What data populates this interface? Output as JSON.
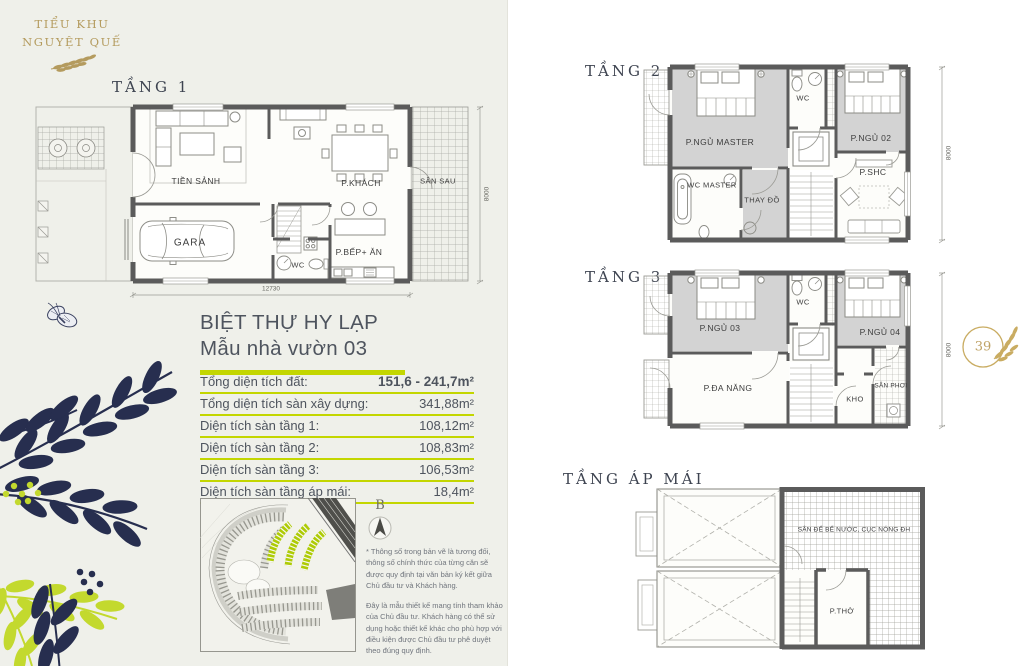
{
  "colors": {
    "accent_green": "#c3d600",
    "gold": "#b49b5e",
    "navy": "#272e4f",
    "wall_gray": "#5b5b5b",
    "room_gray": "#d3d3d3",
    "bg_left": "#eff0ea",
    "bg_right": "#ffffff"
  },
  "logo": {
    "line1": "TIỂU KHU",
    "line2": "NGUYỆT QUẾ"
  },
  "floor1": {
    "label": "TẦNG 1",
    "rooms": {
      "tien_sanh": "TIỀN SẢNH",
      "p_khach": "P.KHÁCH",
      "san_sau": "SÂN SAU",
      "gara": "GARA",
      "p_bep_an": "P.BẾP+ ĂN",
      "wc": "WC"
    },
    "dims": {
      "width": "12730",
      "height": "8000"
    }
  },
  "floor2": {
    "label": "TẦNG 2",
    "rooms": {
      "p_ngu_master": "P.NGỦ MASTER",
      "wc": "WC",
      "p_ngu_02": "P.NGỦ 02",
      "wc_master": "WC MASTER",
      "thay_do": "THAY ĐỒ",
      "p_shc": "P.SHC"
    },
    "dims": {
      "height": "8000"
    }
  },
  "floor3": {
    "label": "TẦNG 3",
    "rooms": {
      "p_ngu_03": "P.NGỦ 03",
      "wc": "WC",
      "p_ngu_04": "P.NGỦ 04",
      "p_da_nang": "P.ĐA NĂNG",
      "kho": "KHO",
      "san_phoi": "SÂN PHƠI"
    },
    "dims": {
      "height": "8000"
    }
  },
  "attic": {
    "label": "TẦNG ÁP MÁI",
    "rooms": {
      "san_ky_thuat": "SÂN ĐỂ BỂ NƯỚC, CỤC NÓNG ĐH",
      "p_tho": "P.THỜ"
    }
  },
  "info": {
    "title_line1": "BIỆT THỰ HY LẠP",
    "title_line2": "Mẫu nhà vườn 03",
    "rows": [
      {
        "label": "Tổng diện tích đất:",
        "value": "151,6 - 241,7m²"
      },
      {
        "label": "Tổng diện tích sàn xây dựng:",
        "value": "341,88m²"
      },
      {
        "label": "Diện tích sàn tầng 1:",
        "value": "108,12m²"
      },
      {
        "label": "Diện tích sàn tầng 2:",
        "value": "108,83m²"
      },
      {
        "label": "Diện tích sàn tầng 3:",
        "value": "106,53m²"
      },
      {
        "label": "Diện tích sàn tầng áp mái:",
        "value": "18,4m²"
      }
    ]
  },
  "compass": {
    "label": "B"
  },
  "badge": {
    "number": "39"
  },
  "notes": {
    "para1": "* Thông số trong bản vẽ là tương đối, thông số chính thức của từng căn sẽ được quy định tại văn bản ký kết giữa Chủ đầu tư và Khách hàng.",
    "para2": "Đây là mẫu thiết kế mang tính tham khảo của Chủ đầu tư. Khách hàng có thể sử dụng hoặc thiết kế khác cho phù hợp với điều kiện được Chủ đầu tư phê duyệt theo đúng quy định."
  }
}
